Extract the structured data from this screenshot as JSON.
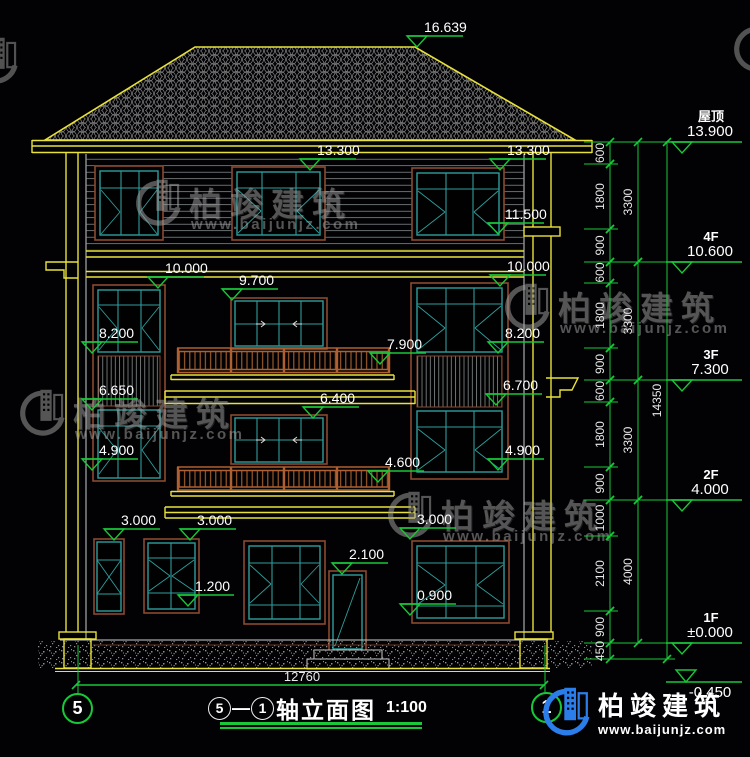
{
  "drawing_title": {
    "axis_from": "5",
    "sep": "—",
    "axis_to": "1",
    "name": "轴立面图",
    "scale": "1:100"
  },
  "axes": {
    "left": "5",
    "right": "1"
  },
  "bottom_dimension": "12760",
  "watermark": {
    "brand": "柏竣建筑",
    "url": "www.baijunjz.com"
  },
  "logo": {
    "brand": "柏竣建筑",
    "url": "www.baijunjz.com"
  },
  "elevation_markers": [
    {
      "t": "16.639",
      "x": 407,
      "y": 36
    },
    {
      "t": "13.300",
      "x": 300,
      "y": 159
    },
    {
      "t": "13.300",
      "x": 490,
      "y": 159
    },
    {
      "t": "11.500",
      "x": 488,
      "y": 223
    },
    {
      "t": "10.000",
      "x": 148,
      "y": 277
    },
    {
      "t": "10.000",
      "x": 490,
      "y": 275
    },
    {
      "t": "9.700",
      "x": 222,
      "y": 289
    },
    {
      "t": "8.200",
      "x": 82,
      "y": 342
    },
    {
      "t": "8.200",
      "x": 488,
      "y": 342
    },
    {
      "t": "7.900",
      "x": 370,
      "y": 353
    },
    {
      "t": "6.650",
      "x": 82,
      "y": 399
    },
    {
      "t": "6.700",
      "x": 486,
      "y": 394
    },
    {
      "t": "6.400",
      "x": 303,
      "y": 407
    },
    {
      "t": "4.900",
      "x": 82,
      "y": 459
    },
    {
      "t": "4.900",
      "x": 488,
      "y": 459
    },
    {
      "t": "4.600",
      "x": 368,
      "y": 471
    },
    {
      "t": "3.000",
      "x": 104,
      "y": 529
    },
    {
      "t": "3.000",
      "x": 180,
      "y": 529
    },
    {
      "t": "3.000",
      "x": 400,
      "y": 528
    },
    {
      "t": "2.100",
      "x": 332,
      "y": 563
    },
    {
      "t": "1.200",
      "x": 178,
      "y": 595
    },
    {
      "t": "0.900",
      "x": 400,
      "y": 604
    }
  ],
  "floor_levels": [
    {
      "n": "屋顶",
      "e": "13.900",
      "y": 142
    },
    {
      "n": "4F",
      "e": "10.600",
      "y": 262
    },
    {
      "n": "3F",
      "e": "7.300",
      "y": 380
    },
    {
      "n": "2F",
      "e": "4.000",
      "y": 500
    },
    {
      "n": "1F",
      "e": "±0.000",
      "y": 643
    },
    {
      "n": "",
      "e": "-0.450",
      "y": 682,
      "f": 1
    }
  ],
  "dim_chains": [
    {
      "x": 610,
      "lx": 600,
      "segments": [
        [
          "600",
          142,
          164
        ],
        [
          "1800",
          164,
          229
        ],
        [
          "900",
          229,
          262
        ],
        [
          "600",
          262,
          283
        ],
        [
          "1800",
          283,
          348
        ],
        [
          "900",
          348,
          380
        ],
        [
          "600",
          380,
          402
        ],
        [
          "1800",
          402,
          467
        ],
        [
          "900",
          467,
          500
        ],
        [
          "1000",
          500,
          536
        ],
        [
          "2100",
          536,
          611
        ],
        [
          "900",
          611,
          643
        ],
        [
          "450",
          643,
          659
        ]
      ]
    },
    {
      "x": 638,
      "lx": 628,
      "segments": [
        [
          "3300",
          142,
          262
        ],
        [
          "3300",
          262,
          380
        ],
        [
          "3300",
          380,
          500
        ],
        [
          "4000",
          500,
          643
        ]
      ]
    },
    {
      "x": 667,
      "lx": 657,
      "segments": [
        [
          "14350",
          142,
          659
        ]
      ]
    }
  ],
  "floor_tick_ys": [
    142,
    262,
    380,
    500,
    643,
    659
  ],
  "colors": {
    "line_yellow": "#e8e13a",
    "dim_green": "#18c838",
    "window_teal": "#2f9d9d",
    "frame_brown": "#8c4a2f",
    "rail_brown": "#b06030",
    "logo_blue": "#2b7de9",
    "watermark_gray": "#a2a2a2"
  }
}
